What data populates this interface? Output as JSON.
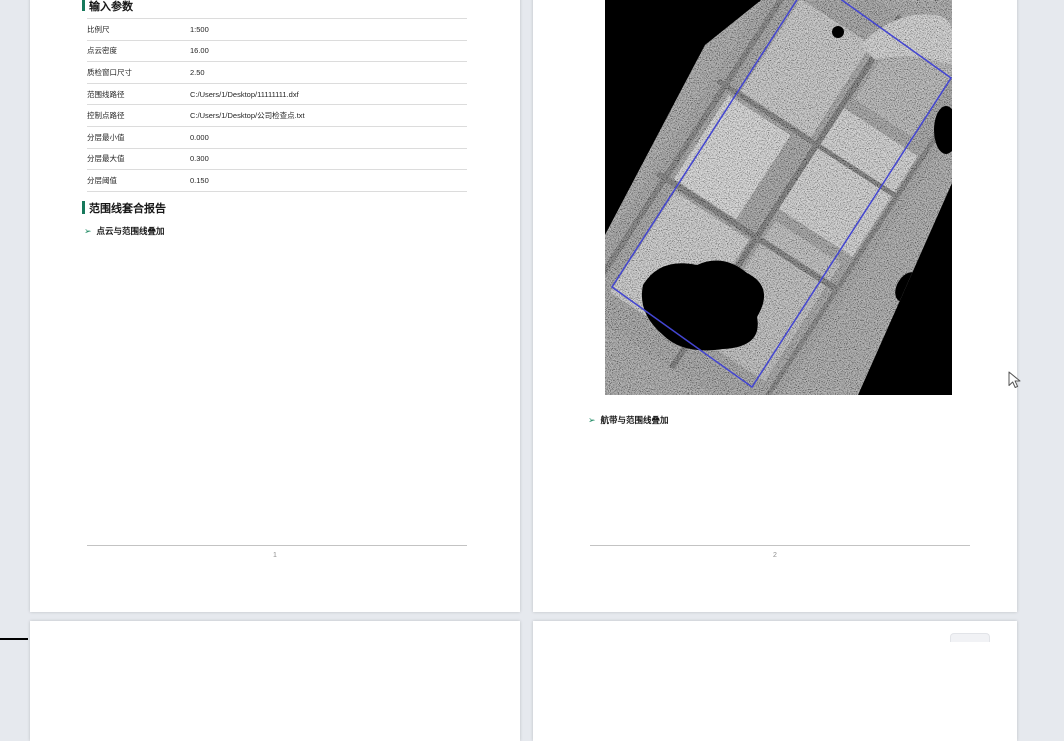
{
  "colors": {
    "accent_green": "#17795c",
    "boundary_blue": "#4345d1",
    "viewer_bg": "#e6e9ee"
  },
  "page1": {
    "section_input_params": {
      "title": "输入参数"
    },
    "table": {
      "rows": [
        {
          "label": "比例尺",
          "value": "1:500"
        },
        {
          "label": "点云密度",
          "value": "16.00"
        },
        {
          "label": "质检窗口尺寸",
          "value": "2.50"
        },
        {
          "label": "范围线路径",
          "value": "C:/Users/1/Desktop/11111111.dxf"
        },
        {
          "label": "控制点路径",
          "value": "C:/Users/1/Desktop/公司检查点.txt"
        },
        {
          "label": "分层最小值",
          "value": "0.000"
        },
        {
          "label": "分层最大值",
          "value": "0.300"
        },
        {
          "label": "分层阈值",
          "value": "0.150"
        }
      ]
    },
    "section_range_report": {
      "title": "范围线套合报告",
      "bullet_icon": "➢",
      "bullet": "点云与范围线叠加"
    },
    "page_number": "1"
  },
  "page2": {
    "bullet_icon": "➢",
    "bullet": "航带与范围线叠加",
    "page_number": "2"
  }
}
